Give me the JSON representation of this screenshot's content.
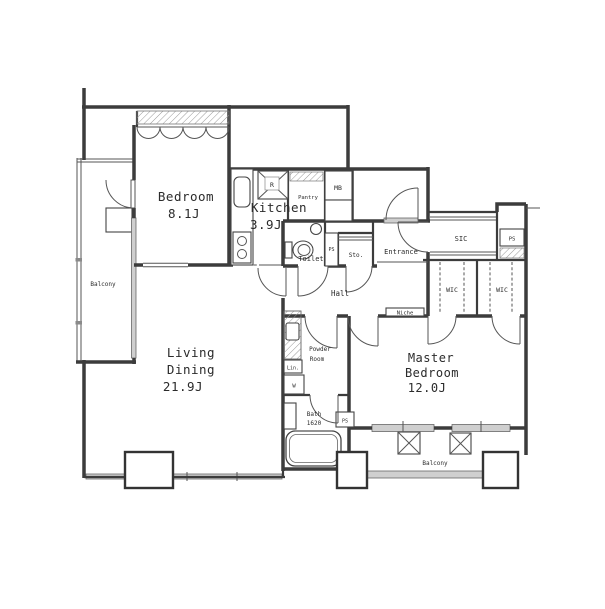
{
  "plan": {
    "type": "apartment-floor-plan",
    "rooms": {
      "bedroom": {
        "name": "Bedroom",
        "size": "8.1J"
      },
      "kitchen": {
        "name": "Kitchen",
        "size": "3.9J"
      },
      "living": {
        "line1": "Living",
        "line2": "Dining",
        "size": "21.9J"
      },
      "master": {
        "line1": "Master",
        "line2": "Bedroom",
        "size": "12.0J"
      }
    },
    "labels": {
      "balcony": "Balcony",
      "toilet": "Toilet",
      "hall": "Hall",
      "niche": "Niche",
      "entrance": "Entrance",
      "storage": "Sto.",
      "pantry": "Pantry",
      "meter_box": "MB",
      "pipe_space": "PS",
      "shoe_closet": "SIC",
      "walk_in_closet": "WIC",
      "powder_line1": "Powder",
      "powder_line2": "Room",
      "bath": "Bath",
      "bath_size": "1620",
      "linen": "Lin.",
      "washer": "W",
      "refrigerator": "R"
    },
    "colors": {
      "wall": "#3c3c3c",
      "glazing": "#cfcfcf",
      "background": "#ffffff"
    }
  }
}
